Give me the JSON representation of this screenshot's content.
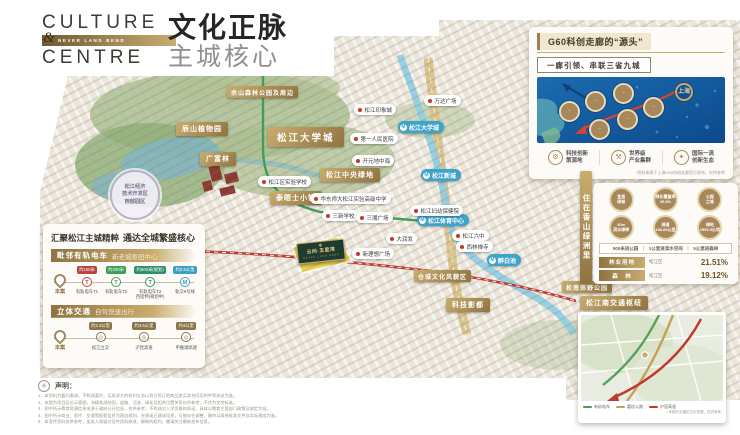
{
  "brand": {
    "line1": "CULTURE",
    "amp": "&",
    "band": "NEVER LAND BEND",
    "line2": "CENTRE",
    "title_bold": "文化正脉",
    "title_light": "主城核心",
    "gold": "#c9ad6f"
  },
  "g60_panel": {
    "title": "G60科创走廊的“源头”",
    "subtitle": "一廊引领、串联三省九城",
    "circles": [
      {
        "x": 138,
        "y": 6,
        "text": "上海",
        "cls": "sh"
      },
      {
        "x": 22,
        "y": 24,
        "text": "···",
        "cls": ""
      },
      {
        "x": 48,
        "y": 14,
        "text": "···",
        "cls": ""
      },
      {
        "x": 76,
        "y": 6,
        "text": "···",
        "cls": ""
      },
      {
        "x": 106,
        "y": 20,
        "text": "···",
        "cls": ""
      },
      {
        "x": 80,
        "y": 32,
        "text": "···",
        "cls": ""
      },
      {
        "x": 52,
        "y": 42,
        "text": "···",
        "cls": ""
      }
    ],
    "features": [
      {
        "icon": "⚙",
        "l1": "科技创新",
        "l2": "策源地"
      },
      {
        "icon": "⚒",
        "l1": "世界级",
        "l2": "产业集群"
      },
      {
        "icon": "✦",
        "l1": "国际一流",
        "l2": "创新生态"
      }
    ],
    "footnote": "*资料来源于上海G60科创走廊官方发布，仅供参考"
  },
  "left_panel": {
    "title_a": "汇聚松江主城精粹",
    "title_b": "通达全城繁盛核心",
    "section1": {
      "bar_a": "毗邻有轨电车",
      "bar_b": "新老城枢纽中心",
      "origin": "本案",
      "stops": [
        {
          "banner": "约100米",
          "name": "有轨电车T1",
          "glyph": "T",
          "color": "#b5443f"
        },
        {
          "banner": "约200米",
          "name": "有轨电车T2",
          "glyph": "T",
          "color": "#3f9e57"
        },
        {
          "banner": "约600米(规划)",
          "name": "有轨电车T2\n西延伸(规划中)",
          "glyph": "T",
          "color": "#2f8f6e"
        },
        {
          "banner": "约2.5公里",
          "name": "轨交9号线",
          "glyph": "M",
          "color": "#3e9fc4"
        }
      ]
    },
    "section2": {
      "bar_a": "立体交通",
      "bar_b": "自驾快速出行",
      "origin": "本案",
      "stops": [
        {
          "banner": "约3.3公里",
          "name": "松江立交",
          "glyph": "◎",
          "color": "#8a744a"
        },
        {
          "banner": "约3.5公里",
          "name": "沪昆高速",
          "glyph": "◎",
          "color": "#8a744a"
        },
        {
          "banner": "约4公里",
          "name": "申嘉湖高速",
          "glyph": "◎",
          "color": "#8a744a"
        }
      ]
    }
  },
  "green_panel": {
    "strip": "住在香山绿洲里",
    "medals": [
      {
        "l1": "宜居",
        "l2": "绿城"
      },
      {
        "l1": "绿化覆盖率",
        "l2": "25.8%"
      },
      {
        "l1": "公园",
        "l2": "之城"
      },
      {
        "l1": "30m",
        "l2": "滨水绿带"
      },
      {
        "l1": "绿道",
        "l2": "108.86公里"
      },
      {
        "l1": "绿地",
        "l2": "1505.5公顷"
      }
    ],
    "slogan": [
      "500米进公园",
      "1公里进滨水空间",
      "5公里进森林"
    ],
    "stats": [
      {
        "bar": "林业用地",
        "sub": "松江区",
        "value": "21.51%"
      },
      {
        "bar": "森　林",
        "sub": "松江区",
        "value": "19.12%"
      }
    ]
  },
  "map": {
    "labels": [
      {
        "type": "banner-sm",
        "text": "佘山森林公园及周边",
        "x": 227,
        "y": 86
      },
      {
        "type": "banner",
        "text": "辰山植物园",
        "x": 176,
        "y": 122
      },
      {
        "type": "banner",
        "text": "广富林",
        "x": 200,
        "y": 152
      },
      {
        "type": "banner-lg",
        "text": "松江大学城",
        "x": 268,
        "y": 127
      },
      {
        "type": "banner",
        "text": "松江中央绿地",
        "x": 320,
        "y": 168
      },
      {
        "type": "banner",
        "text": "泰晤士小镇",
        "x": 270,
        "y": 191
      },
      {
        "type": "banner-sm",
        "text": "仓城文化风貌区",
        "x": 414,
        "y": 270
      },
      {
        "type": "banner",
        "text": "科技影都",
        "x": 446,
        "y": 298
      },
      {
        "type": "banner-sm",
        "text": "松南郊野公园",
        "x": 562,
        "y": 281
      },
      {
        "type": "banner",
        "text": "松江南交通枢纽",
        "x": 580,
        "y": 296
      },
      {
        "type": "metro",
        "text": "松江大学城",
        "x": 398,
        "y": 121
      },
      {
        "type": "metro",
        "text": "松江新城",
        "x": 421,
        "y": 169
      },
      {
        "type": "metro",
        "text": "松江体育中心",
        "x": 417,
        "y": 214
      },
      {
        "type": "metro",
        "text": "醉白池",
        "x": 487,
        "y": 254
      },
      {
        "type": "poi",
        "text": "松江印象城",
        "x": 354,
        "y": 104
      },
      {
        "type": "poi",
        "text": "万达广场",
        "x": 424,
        "y": 95
      },
      {
        "type": "poi",
        "text": "第一人民医院",
        "x": 350,
        "y": 133
      },
      {
        "type": "poi",
        "text": "开元地中海",
        "x": 352,
        "y": 155
      },
      {
        "type": "poi",
        "text": "松江区实验学校",
        "x": 258,
        "y": 176
      },
      {
        "type": "poi",
        "text": "华东师大松江实验高级中学",
        "x": 310,
        "y": 193
      },
      {
        "type": "poi",
        "text": "三新学校",
        "x": 322,
        "y": 210
      },
      {
        "type": "poi",
        "text": "三湘广场",
        "x": 356,
        "y": 212
      },
      {
        "type": "poi",
        "text": "松江妇幼保健院",
        "x": 410,
        "y": 205
      },
      {
        "type": "poi",
        "text": "大润发",
        "x": 386,
        "y": 233
      },
      {
        "type": "poi",
        "text": "松江六中",
        "x": 452,
        "y": 230
      },
      {
        "type": "poi",
        "text": "西林禅寺",
        "x": 456,
        "y": 241
      },
      {
        "type": "poi",
        "text": "新理想广场",
        "x": 352,
        "y": 248
      }
    ],
    "plaque": {
      "mono": "❖",
      "name": "云间·五里湾",
      "sub": "NEVER LAND BEND"
    },
    "devzone": [
      "松江经济",
      "技术开发区",
      "西部园区"
    ]
  },
  "inset": {
    "legend": [
      {
        "color": "#3f9e57",
        "label": "有轨电车"
      },
      {
        "color": "#c2a25a",
        "label": "嘉松公路"
      },
      {
        "color": "#c0392b",
        "label": "沪昆高速"
      }
    ],
    "caption": "*本图为交通区位示意图，仅供参考"
  },
  "declaration": {
    "heading": "声明：",
    "lines": [
      "1、本资料为要约邀请，不构成要约，买卖双方的权利义务以双方签订的商品房买卖合同及附件等协议为准。",
      "2、本图为项目区位示意图，非精准测绘图，道路、河流、绿化及相关位置关系仅供参考，不作为交付标准。",
      "3、图中所示教育资源信息来源于政府公开信息，仅供参考，不构成对入学资格的承诺，具体以教育主管部门政策及规定为准。",
      "4、图中所示商业、医疗、交通等配套信息为周边规划、在建或已建成信息，可能存在调整，最终以政府批准文件及实际建成为准。",
      "5、本宣传资料仅供参考，出卖人保留对宣传资料修改、解释的权利，敬请关注最新发布信息。"
    ]
  }
}
